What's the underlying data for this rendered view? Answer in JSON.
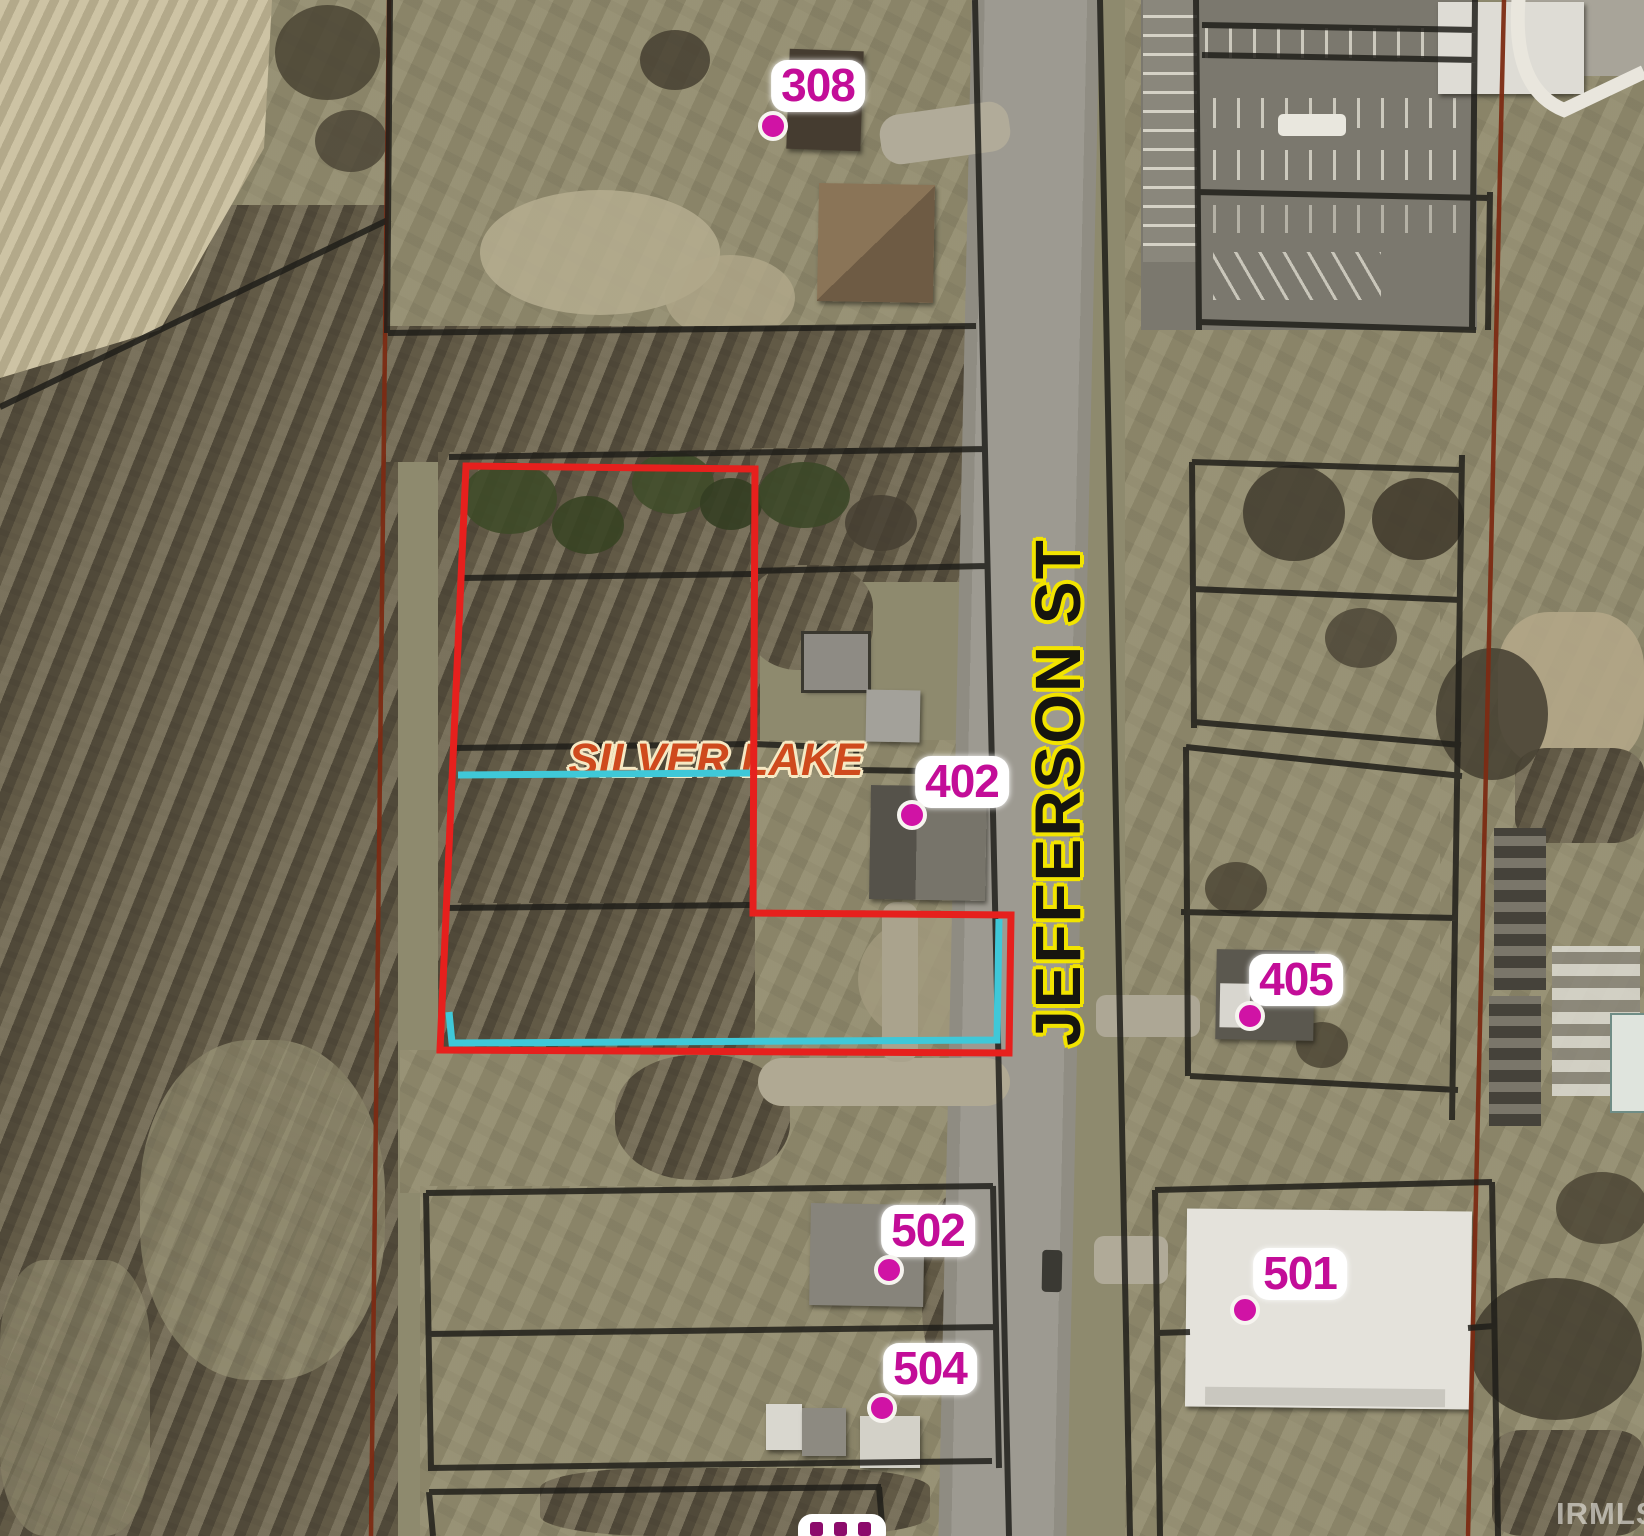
{
  "map": {
    "watermark": "IRMLS",
    "street": {
      "name": "JEFFERSON ST"
    },
    "water": {
      "name": "SILVER LAKE"
    },
    "parcel_labels": [
      {
        "id": "308",
        "text": "308"
      },
      {
        "id": "402",
        "text": "402"
      },
      {
        "id": "405",
        "text": "405"
      },
      {
        "id": "501",
        "text": "501"
      },
      {
        "id": "502",
        "text": "502"
      },
      {
        "id": "504",
        "text": "504"
      }
    ],
    "colors": {
      "highlight_red": "#e6201d",
      "water_cyan": "#3fc8d8",
      "label_magenta": "#c30d98",
      "dot_magenta": "#d013a5",
      "street_text": "#16150f",
      "street_halo": "#f2e400",
      "water_text": "#cf4a1d",
      "water_halo": "#f6e9c4",
      "parcel_line": "#201f1a",
      "section_line": "#7c2b13",
      "watermark_color": "#eceae4"
    }
  }
}
